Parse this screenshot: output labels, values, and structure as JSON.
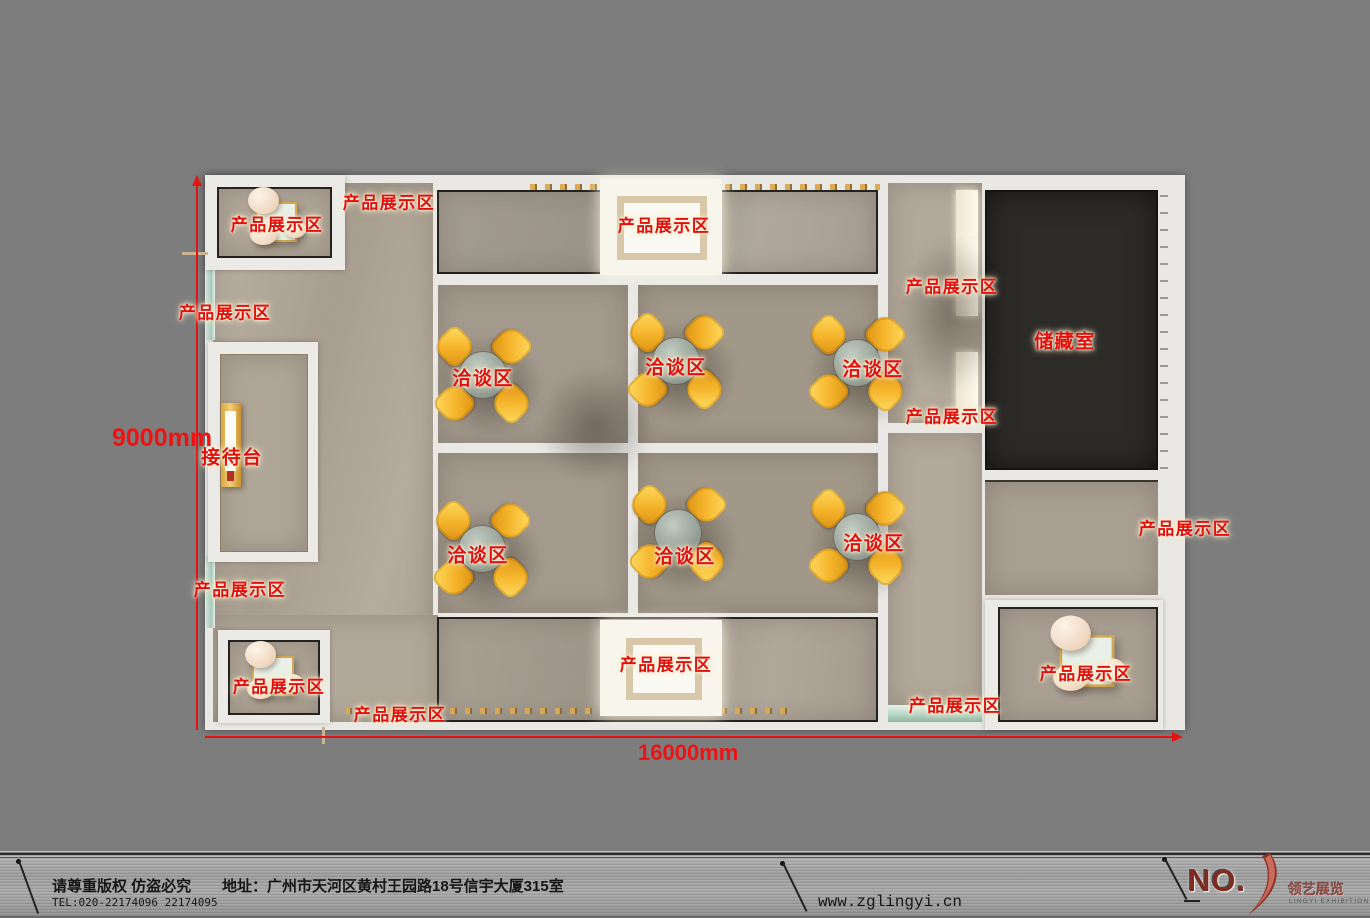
{
  "plan": {
    "labels": [
      {
        "text": "产品展示区"
      },
      {
        "text": "产品展示区"
      },
      {
        "text": "产品展示区"
      },
      {
        "text": "产品展示区"
      },
      {
        "text": "接待台"
      },
      {
        "text": "产品展示区"
      },
      {
        "text": "产品展示区"
      },
      {
        "text": "产品展示区"
      },
      {
        "text": "产品展示区"
      },
      {
        "text": "产品展示区"
      },
      {
        "text": "产品展示区"
      },
      {
        "text": "产品展示区"
      },
      {
        "text": "储藏室"
      },
      {
        "text": "产品展示区"
      },
      {
        "text": "产品展示区"
      },
      {
        "text": "洽谈区"
      },
      {
        "text": "洽谈区"
      },
      {
        "text": "洽谈区"
      },
      {
        "text": "洽谈区"
      },
      {
        "text": "洽谈区"
      },
      {
        "text": "洽谈区"
      }
    ],
    "dimensions": {
      "height_label": "9000mm",
      "width_label": "16000mm"
    }
  },
  "footer": {
    "copyright": "请尊重版权 仿盗必究",
    "tel": "TEL:020-22174096 22174095",
    "address": "地址：广州市天河区黄村王园路18号信宇大厦315室",
    "website": "www.zglingyi.cn",
    "logo_text": "NO.",
    "brand": "领艺展览",
    "brand_en": "LINGYI EXHIBITION"
  },
  "colors": {
    "background_gray": "#7d7d7d",
    "wall_white": "#e9e8e4",
    "floor_beige": "#b1a799",
    "floor_dark": "#a39a8d",
    "storage_dark": "#2d2b28",
    "label_red": "#e31009",
    "dimension_red": "#ee1212",
    "chair_yellow": "#f4b32a",
    "table_gray": "#909a91",
    "shelf_teal": "#cfe2d6"
  }
}
